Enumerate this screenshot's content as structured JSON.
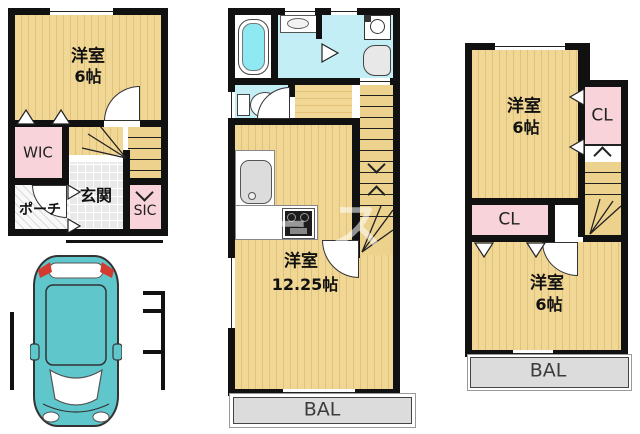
{
  "floor1": {
    "room": "洋室",
    "room_size": "6帖",
    "wic": "WIC",
    "genkan": "玄関",
    "porch": "ポーチ",
    "sic": "SIC"
  },
  "floor2": {
    "room": "洋室",
    "room_size": "12.25帖",
    "balcony": "BAL"
  },
  "floor3": {
    "room_top": "洋室",
    "room_top_size": "6帖",
    "cl_right": "CL",
    "cl_lower": "CL",
    "room_bottom": "洋室",
    "room_bottom_size": "6帖",
    "balcony": "BAL"
  },
  "watermark": "ース",
  "colors": {
    "room_yellow": "#ecd28d",
    "closet_pink": "#f8d3d9",
    "water_cyan": "#c3eef6",
    "tub_water": "#8fe9f2",
    "balcony_gray": "#dcdcdc",
    "wall_black": "#111111",
    "car_teal": "#5fc6cc"
  }
}
